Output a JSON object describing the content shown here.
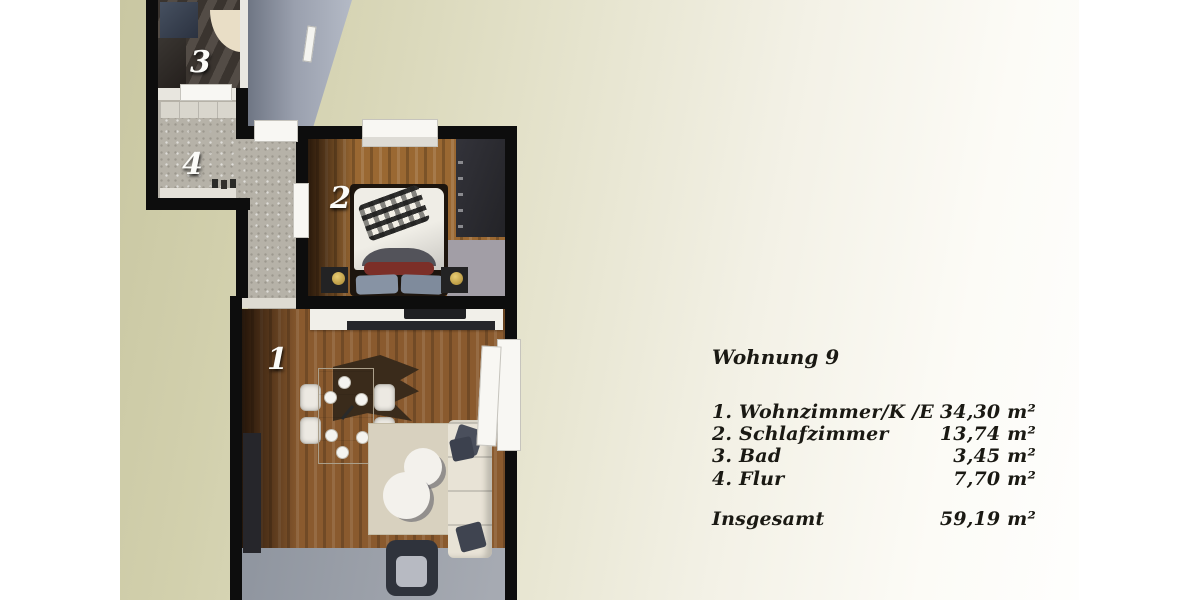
{
  "header": {
    "title": "Wohnung 9"
  },
  "legend": {
    "rows": [
      {
        "label": "1. Wohnzimmer/K /E",
        "value": "34,30 m²"
      },
      {
        "label": "2. Schlafzimmer",
        "value": "13,74 m²"
      },
      {
        "label": "3. Bad",
        "value": "3,45 m²"
      },
      {
        "label": "4. Flur",
        "value": "7,70 m²"
      }
    ],
    "total": {
      "label": "Insgesamt",
      "value": "59,19 m²"
    }
  },
  "plan": {
    "room_labels": {
      "living": "1",
      "bedroom": "2",
      "bath": "3",
      "hall": "4"
    }
  },
  "colors": {
    "background_olive": "#c9c7a2",
    "background_cream": "#f3f1e6",
    "wall": "#0d0d0d",
    "wood_floor": "#8a5a2e",
    "stone_floor": "#b6b2a8",
    "text": "#1a1913"
  }
}
